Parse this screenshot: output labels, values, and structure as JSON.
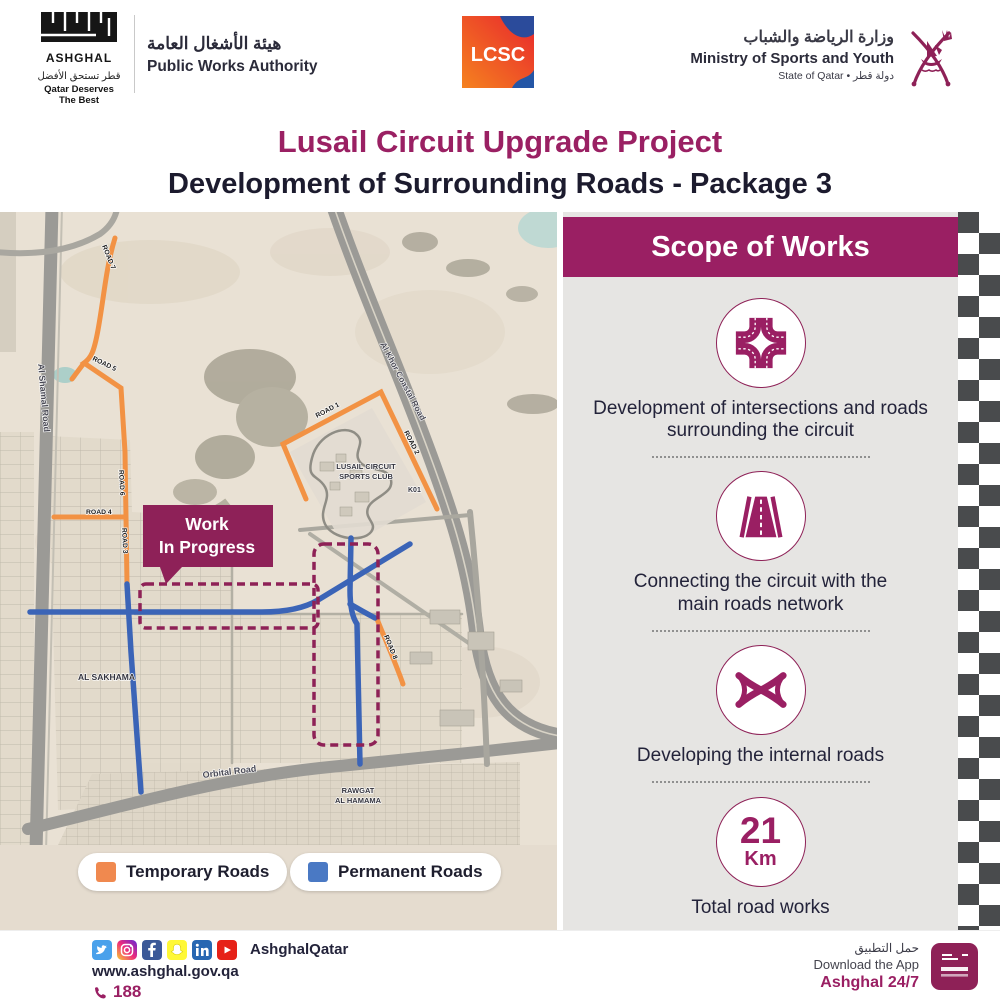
{
  "header": {
    "ashghal": {
      "wordmark": "ASHGHAL",
      "name_ar": "هيئة الأشغال العامة",
      "name_en": "Public Works Authority",
      "tagline_ar": "قطر تستحق الأفضل",
      "tagline_en": "Qatar Deserves The Best"
    },
    "lcsc_label": "LCSC",
    "ministry": {
      "name_ar": "وزارة الرياضة والشباب",
      "name_en": "Ministry of Sports and Youth",
      "state_line": "State of Qatar • دولة قطر"
    },
    "title": "Lusail Circuit Upgrade Project",
    "subtitle": "Development of Surrounding Roads - Package 3"
  },
  "map": {
    "callout": {
      "line1": "Work",
      "line2": "In Progress"
    },
    "labels": {
      "al_shamal_road": "Al Shamal Road",
      "al_khor_coastal_road": "Al Khor Coastal Road",
      "orbital_road": "Orbital Road",
      "al_sakhama": "AL SAKHAMA",
      "rawgat_line1": "RAWGAT",
      "rawgat_line2": "AL HAMAMA",
      "circuit_line1": "LUSAIL CIRCUIT",
      "circuit_line2": "SPORTS CLUB",
      "k01": "K01",
      "road1": "ROAD 1",
      "road2": "ROAD 2",
      "road3": "ROAD 3",
      "road4": "ROAD 4",
      "road5": "ROAD 5",
      "road6": "ROAD 6",
      "road7": "ROAD 7",
      "road8": "ROAD 8"
    },
    "legend": {
      "temporary": {
        "label": "Temporary Roads",
        "color": "#F0894F"
      },
      "permanent": {
        "label": "Permanent Roads",
        "color": "#4A79C4"
      }
    }
  },
  "scope": {
    "title": "Scope of Works",
    "items": [
      {
        "icon": "intersection-icon",
        "text": "Development of intersections and roads surrounding the circuit"
      },
      {
        "icon": "highway-icon",
        "text": "Connecting the circuit with the main roads network"
      },
      {
        "icon": "interchange-icon",
        "text": "Developing the internal roads"
      },
      {
        "icon": "total-distance-badge",
        "value": "21",
        "unit": "Km",
        "text": "Total road works"
      }
    ]
  },
  "footer": {
    "social_handle": "AshghalQatar",
    "website": "www.ashghal.gov.qa",
    "phone": "188",
    "app": {
      "label_ar": "حمل التطبيق",
      "label_en": "Download the App",
      "name": "Ashghal 24/7"
    }
  },
  "colors": {
    "maroon": "#9A1F63",
    "dark_text": "#1C1B2E",
    "panel_gray": "#E6E5E3",
    "checker_dark": "#494B4D",
    "temporary_road": "#F29244",
    "permanent_road": "#3B64B7",
    "map_beige": "#E6DDD0"
  }
}
